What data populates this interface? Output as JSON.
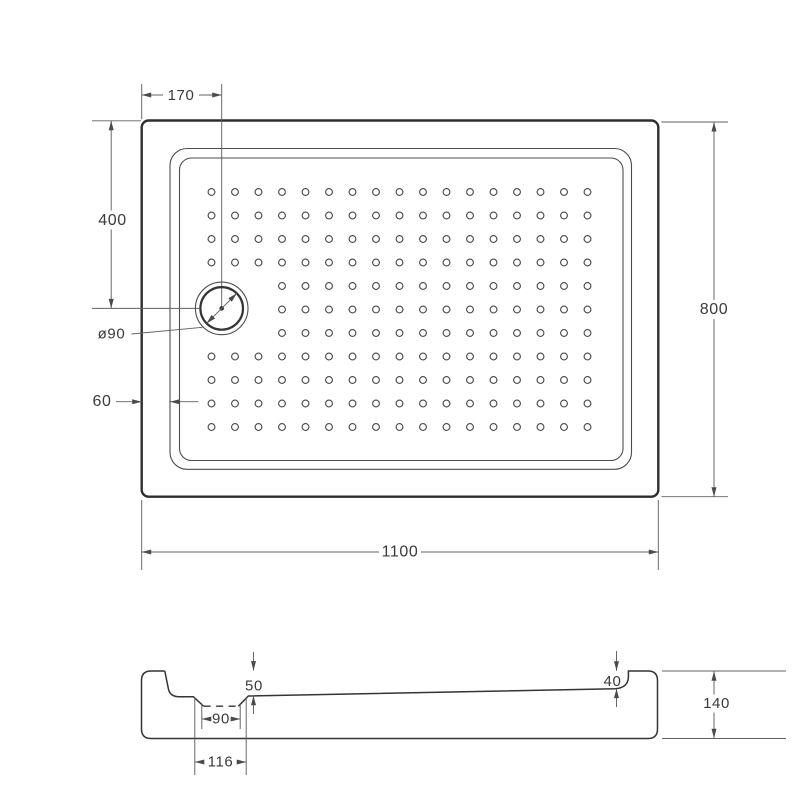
{
  "drawing": {
    "type": "shower-tray-technical-drawing",
    "colors": {
      "background": "#ffffff",
      "outline": "#2d2d2d",
      "thin_line": "#4d4d4d",
      "dimension_line": "#606060",
      "text": "#3a3a3a"
    },
    "top_view": {
      "dim_width": "1100",
      "dim_height": "800",
      "dim_drain_offset_x": "170",
      "dim_drain_offset_y": "400",
      "dim_rim_width": "60",
      "drain_diameter_label": "ø90"
    },
    "side_view": {
      "dim_total_height": "140",
      "dim_depth_at_drain": "50",
      "dim_depth_at_end": "40",
      "dim_sump_bottom_width": "90",
      "dim_sump_top_width": "116"
    }
  }
}
